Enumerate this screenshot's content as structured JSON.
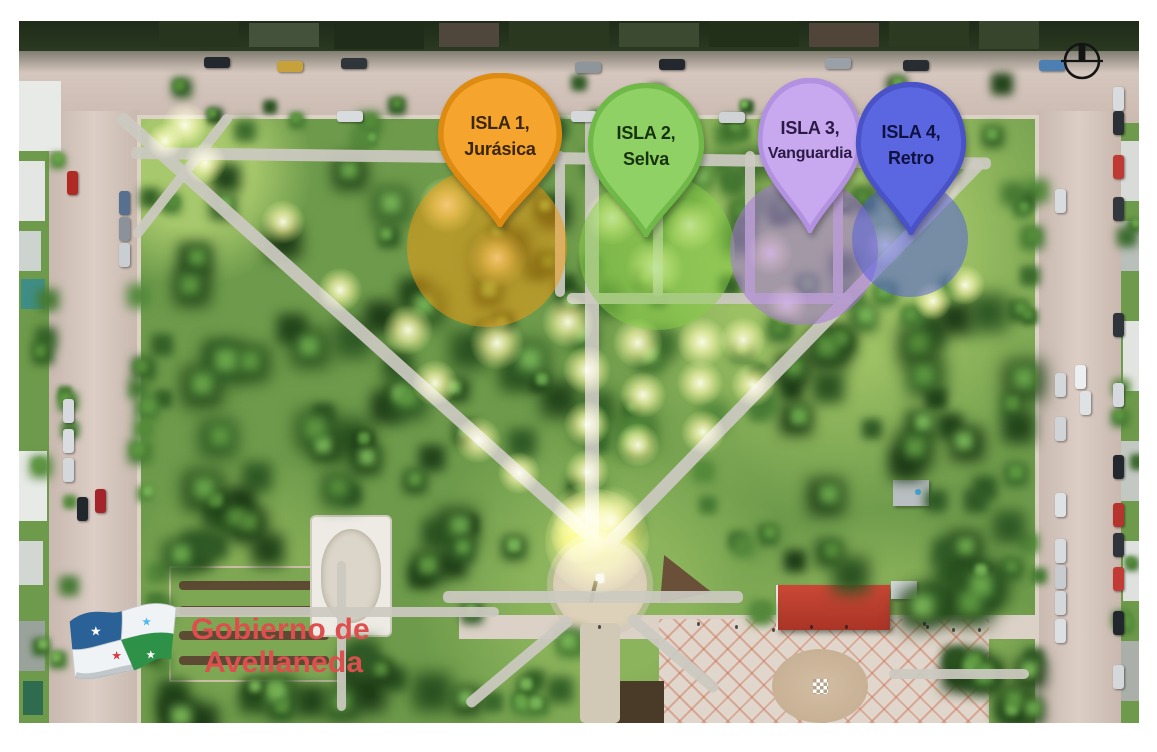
{
  "map": {
    "pins": [
      {
        "line1": "ISLA 1,",
        "line2": "Jurásica",
        "fill": "#F5A42D",
        "stroke": "#DE8B12",
        "text_color": "#3A2604",
        "cx": 481,
        "top": 52,
        "width": 126,
        "height": 154
      },
      {
        "line1": "ISLA 2,",
        "line2": "Selva",
        "fill": "#8FD164",
        "stroke": "#70B948",
        "text_color": "#17320F",
        "cx": 627,
        "top": 62,
        "width": 118,
        "height": 154
      },
      {
        "line1": "ISLA 3,",
        "line2": "Vanguardia",
        "fill": "#C8A9F0",
        "stroke": "#B292E0",
        "text_color": "#2A1A45",
        "cx": 791,
        "top": 57,
        "width": 106,
        "height": 155
      },
      {
        "line1": "ISLA 4,",
        "line2": "Retro",
        "fill": "#5B66E1",
        "stroke": "#4A52C7",
        "text_color": "#0F1240",
        "cx": 892,
        "top": 61,
        "width": 112,
        "height": 153
      }
    ],
    "zones": [
      {
        "name": "jurasica",
        "cx": 468,
        "cy": 226,
        "r": 80,
        "color": "rgba(242,153,17,0.52)"
      },
      {
        "name": "selva",
        "cx": 638,
        "cy": 231,
        "r": 78,
        "color": "rgba(134,205,70,0.50)"
      },
      {
        "name": "vanguardia",
        "cx": 785,
        "cy": 230,
        "r": 74,
        "color": "rgba(167,118,221,0.55)"
      },
      {
        "name": "retro",
        "cx": 891,
        "cy": 218,
        "r": 58,
        "color": "rgba(84,94,224,0.52)"
      }
    ],
    "lights": [
      {
        "x": 166,
        "y": 104,
        "s": 46
      },
      {
        "x": 186,
        "y": 142,
        "s": 42
      },
      {
        "x": 146,
        "y": 120,
        "s": 36
      },
      {
        "x": 264,
        "y": 201,
        "s": 44
      },
      {
        "x": 321,
        "y": 269,
        "s": 44
      },
      {
        "x": 428,
        "y": 184,
        "s": 56
      },
      {
        "x": 478,
        "y": 237,
        "s": 60
      },
      {
        "x": 389,
        "y": 309,
        "s": 50
      },
      {
        "x": 416,
        "y": 362,
        "s": 46
      },
      {
        "x": 459,
        "y": 419,
        "s": 46
      },
      {
        "x": 500,
        "y": 452,
        "s": 42
      },
      {
        "x": 478,
        "y": 322,
        "s": 54
      },
      {
        "x": 549,
        "y": 301,
        "s": 52
      },
      {
        "x": 568,
        "y": 349,
        "s": 48
      },
      {
        "x": 568,
        "y": 403,
        "s": 46
      },
      {
        "x": 568,
        "y": 451,
        "s": 44
      },
      {
        "x": 593,
        "y": 197,
        "s": 54
      },
      {
        "x": 636,
        "y": 247,
        "s": 58
      },
      {
        "x": 671,
        "y": 204,
        "s": 52
      },
      {
        "x": 619,
        "y": 322,
        "s": 50
      },
      {
        "x": 624,
        "y": 374,
        "s": 46
      },
      {
        "x": 619,
        "y": 424,
        "s": 44
      },
      {
        "x": 683,
        "y": 321,
        "s": 50
      },
      {
        "x": 681,
        "y": 362,
        "s": 46
      },
      {
        "x": 684,
        "y": 411,
        "s": 44
      },
      {
        "x": 724,
        "y": 319,
        "s": 46
      },
      {
        "x": 734,
        "y": 364,
        "s": 44
      },
      {
        "x": 751,
        "y": 232,
        "s": 46
      },
      {
        "x": 768,
        "y": 284,
        "s": 42
      },
      {
        "x": 866,
        "y": 224,
        "s": 42
      },
      {
        "x": 921,
        "y": 164,
        "s": 42
      },
      {
        "x": 946,
        "y": 264,
        "s": 40
      },
      {
        "x": 914,
        "y": 280,
        "s": 38
      },
      {
        "x": 564,
        "y": 494,
        "s": 62
      },
      {
        "x": 592,
        "y": 500,
        "s": 70
      },
      {
        "x": 578,
        "y": 520,
        "s": 104,
        "strong": true
      },
      {
        "x": 560,
        "y": 514,
        "s": 56,
        "strong": true
      }
    ]
  },
  "logo": {
    "line1": "Gobierno de",
    "line2": "Avellaneda",
    "color": "#DE4E4E"
  },
  "icons": {
    "compass": "north-compass-icon",
    "flag": "avellaneda-flag-icon"
  }
}
